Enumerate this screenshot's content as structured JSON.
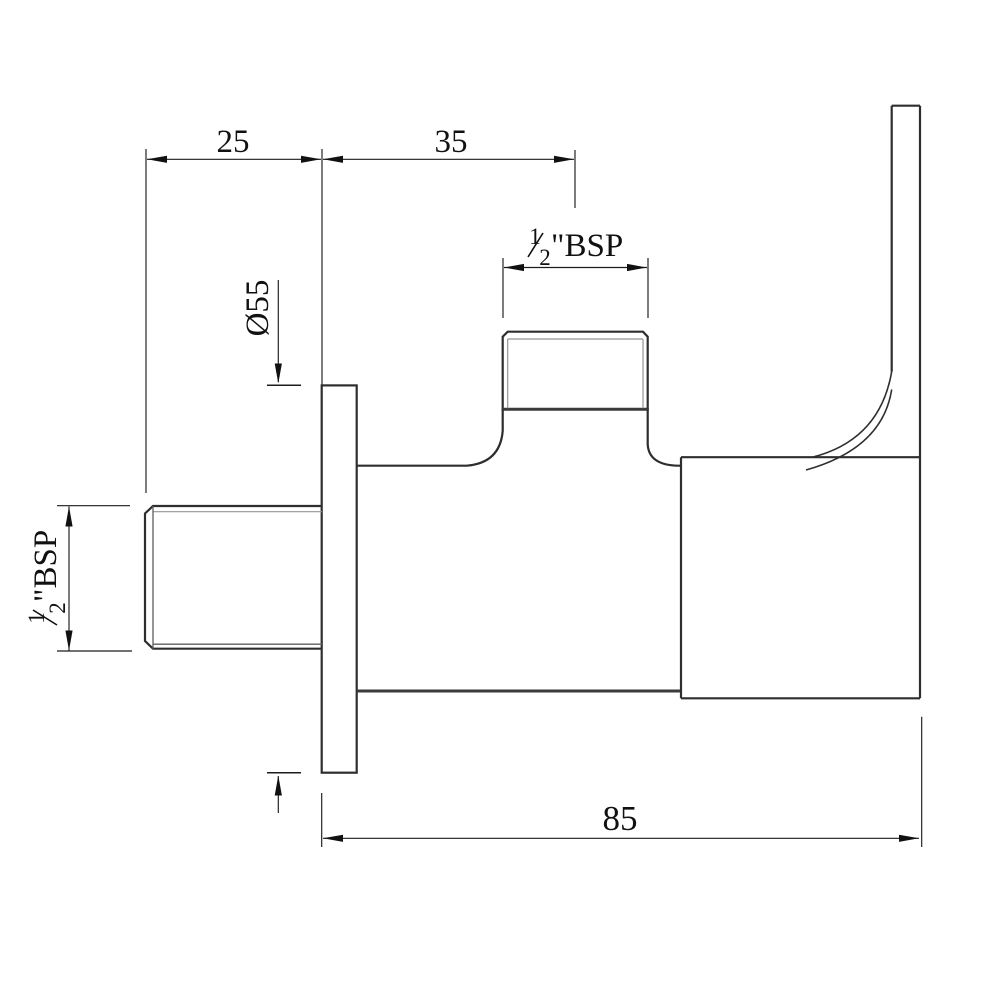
{
  "drawing": {
    "type": "orthographic technical drawing, side elevation of wall-mounted angle valve with flange and lever handle",
    "colors": {
      "background": "#ffffff",
      "outline": "#2e2e2e",
      "dimension_lines": "#1c1c1c",
      "thread_detail_lines": "#949494",
      "text": "#111111"
    },
    "labels": {
      "dim_25": "25",
      "dim_35": "35",
      "dim_85": "85",
      "dim_diameter": "Ø55",
      "bsp_top": {
        "numerator": "1",
        "denominator": "2",
        "suffix": "\"BSP"
      },
      "bsp_left": {
        "numerator": "1",
        "denominator": "2",
        "suffix": "\"BSP"
      }
    }
  }
}
